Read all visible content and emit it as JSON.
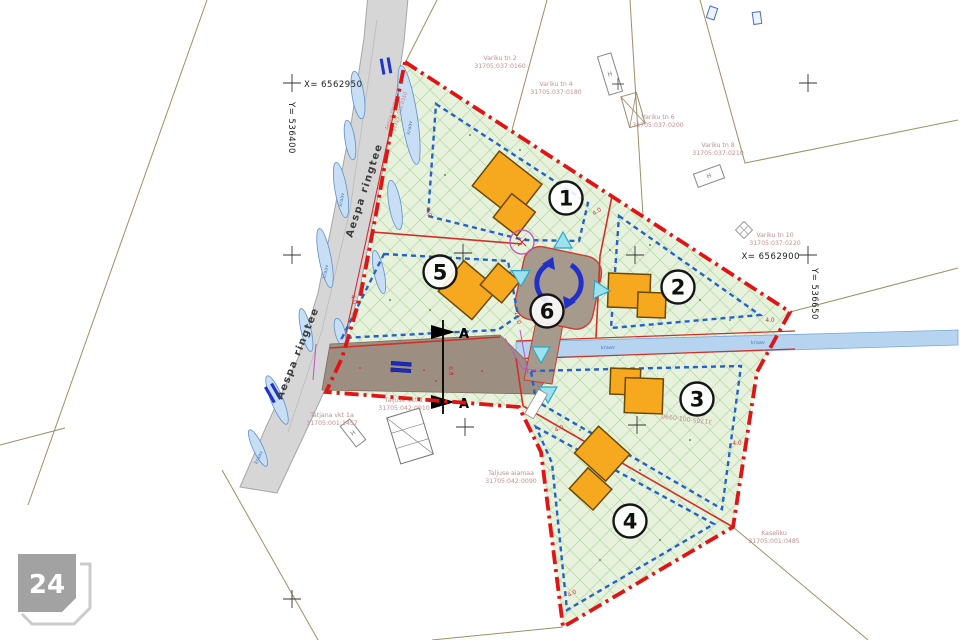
{
  "watermark": {
    "label": "24"
  },
  "coords": {
    "x_nw": "X= 6562950",
    "y_nw": "Y= 536400",
    "x_e": "X= 6562900",
    "y_e": "Y= 536650"
  },
  "road": {
    "name": "Aespa ringtee",
    "code": "31705:002:0310"
  },
  "plots": {
    "p1": "1",
    "p2": "2",
    "p3": "3",
    "p4": "4",
    "p5": "5",
    "p6": "6"
  },
  "parcels": [
    {
      "name": "Variku tn 2",
      "code": "31705:037:0160"
    },
    {
      "name": "Variku tn 4",
      "code": "31705:037:0180"
    },
    {
      "name": "Variku tn 6",
      "code": "31705:037:0200"
    },
    {
      "name": "Variku tn 8",
      "code": "31705:037:0210"
    },
    {
      "name": "Variku tn 10",
      "code": "31705:037:0220"
    },
    {
      "name": "Tatjana vkt 1a",
      "code": "31705:001:1457"
    },
    {
      "name": "Taljuse vkt 1",
      "code": "31705:042:0010"
    },
    {
      "name": "Taljuse aiamaa",
      "code": "31705:042:0090"
    },
    {
      "name": "Kaseliku",
      "code": "31705:001:0485"
    },
    {
      "code": "31705:001:0990"
    }
  ],
  "labels": {
    "ditch": "kraav",
    "section": "A",
    "house": "H"
  },
  "dims": {
    "d4": "4.0",
    "d6": "6.0",
    "d16": "16.0"
  }
}
